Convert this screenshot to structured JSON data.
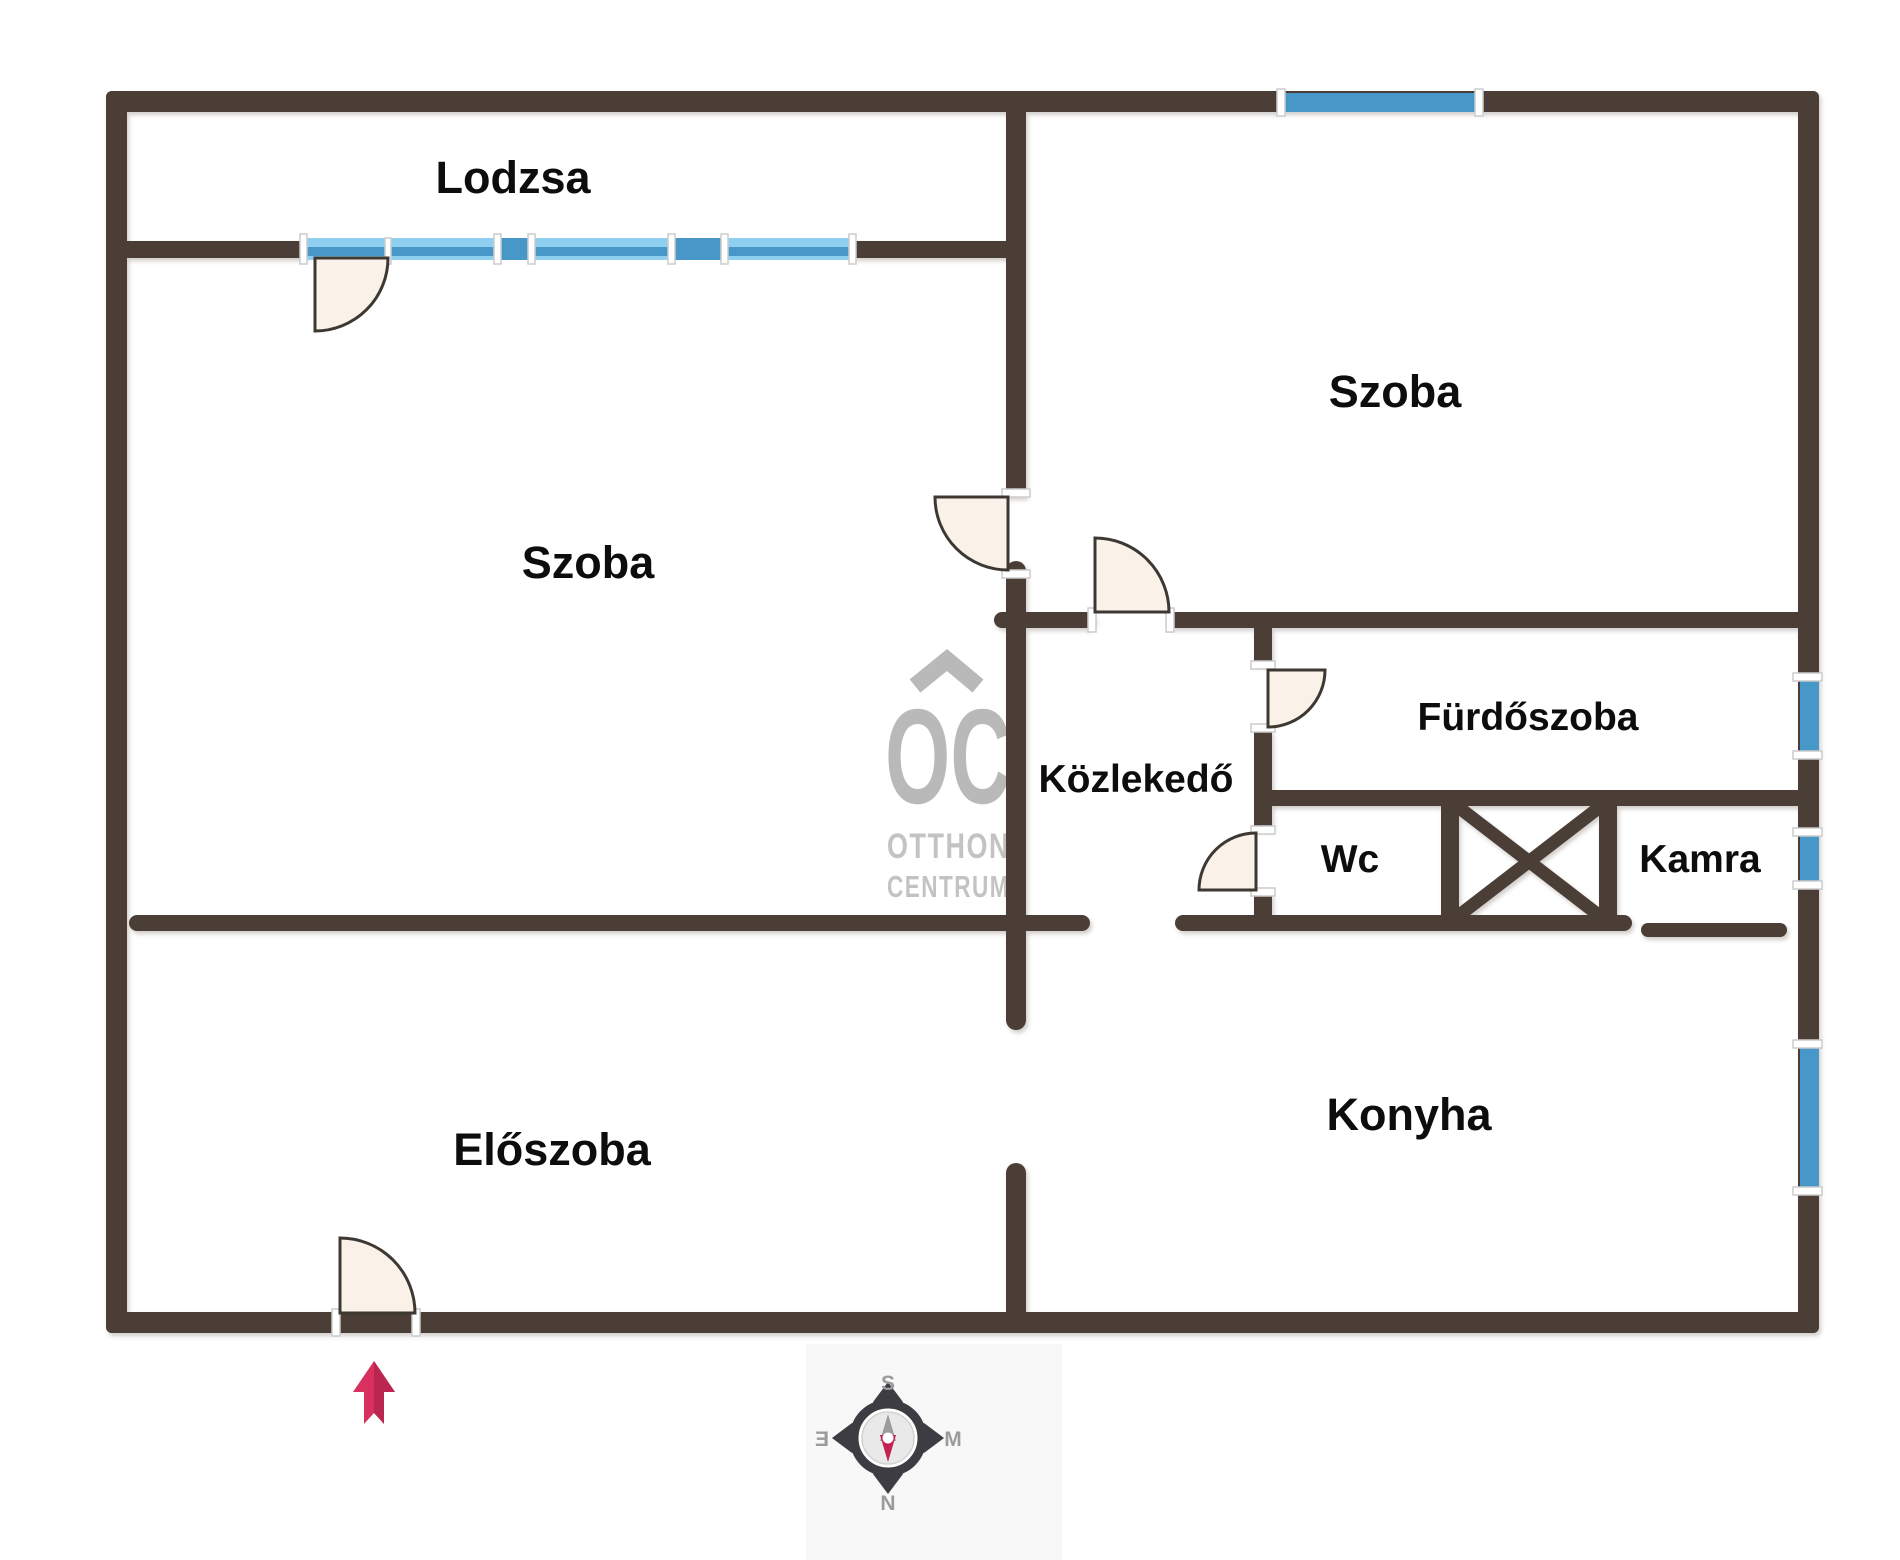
{
  "rooms": {
    "lodzsa": "Lodzsa",
    "szoba_left": "Szoba",
    "szoba_right": "Szoba",
    "furdoszoba": "Fürdőszoba",
    "kozlekedo": "Közlekedő",
    "wc": "Wc",
    "kamra": "Kamra",
    "eloszoba": "Előszoba",
    "konyha": "Konyha"
  },
  "watermark": {
    "logo": "OC",
    "line1": "OTTHON",
    "line2": "CENTRUM"
  },
  "compass": {
    "top": "S",
    "bottom": "N",
    "left": "Ǝ",
    "right": "M"
  },
  "colors": {
    "wall": "#4a3e37",
    "window_solid": "#4798c8",
    "window_light": "#8fd0f0",
    "door_fill": "#faf2e8",
    "entrance_arrow": "#d8315f",
    "compass_needle_red": "#c5204f",
    "watermark_gray": "#b9b9b9",
    "label_black": "#0d0d0d"
  }
}
